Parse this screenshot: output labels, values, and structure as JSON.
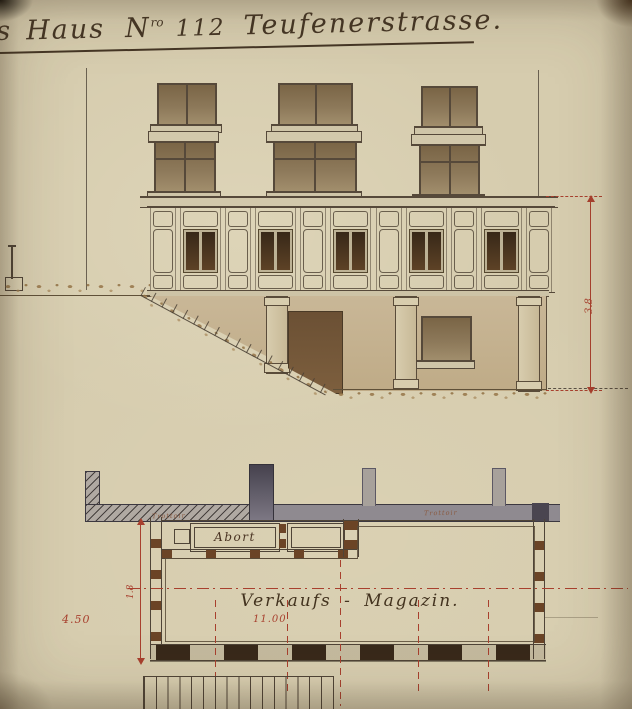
{
  "title": {
    "fragment": "s",
    "word": "Haus",
    "n": "N",
    "n_sup": "ro",
    "number": "112",
    "street": "Teufenerstrasse",
    "period": "."
  },
  "elevation": {
    "height_dim": "3.8"
  },
  "plan": {
    "abort_label": "Abort",
    "room_label": "Verkaufs - Magazin.",
    "width_dim": "11.00",
    "depth_dim": "4.50",
    "center_dim": "1.8",
    "trottoir_left": "Trottoir",
    "trottoir_right": "Trottoir"
  },
  "colors": {
    "paper": "#d6ccae",
    "ink": "#4f4437",
    "drafting_red": "#a8402e",
    "glass_wash": "#8d795a",
    "dark_glass": "#4a3420",
    "wall_wash": "#c8b592",
    "terrain": "#a8895c",
    "plan_grey": "#8f8a90",
    "post_brown": "#6b4426"
  }
}
